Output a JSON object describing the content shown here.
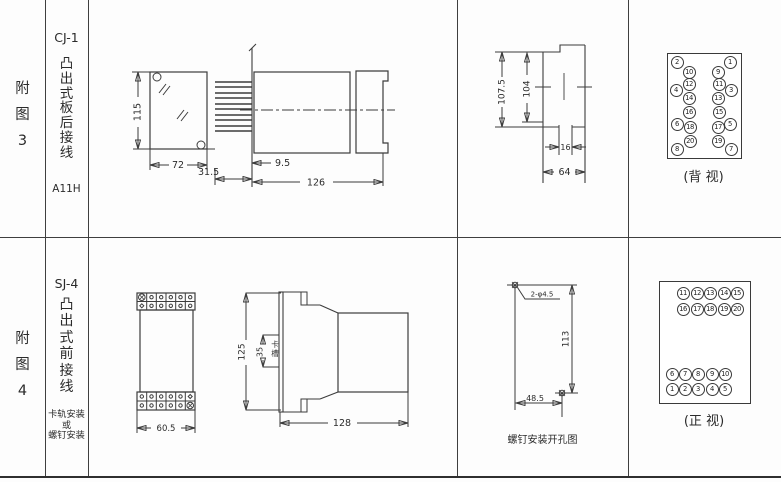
{
  "colors": {
    "line": "#3c3c3c",
    "text": "#2b2b2b"
  },
  "fig3": {
    "row_label": "附图3",
    "model": "CJ-1",
    "mount_type": "凸出式板后接线",
    "code": "A11H",
    "front": {
      "h": "115",
      "w": "72"
    },
    "side": {
      "pin_len": "31.5",
      "offset": "9.5",
      "len": "126"
    },
    "panel": {
      "outer_h": "107.5",
      "inner_h": "104",
      "slot_w": "16",
      "w": "64"
    },
    "terminals": {
      "caption": "(背 视)",
      "items": [
        {
          "n": "2",
          "x": 9,
          "y": 8
        },
        {
          "n": "10",
          "x": 21,
          "y": 18
        },
        {
          "n": "12",
          "x": 21,
          "y": 30
        },
        {
          "n": "4",
          "x": 8,
          "y": 36
        },
        {
          "n": "14",
          "x": 21,
          "y": 44
        },
        {
          "n": "16",
          "x": 21,
          "y": 58
        },
        {
          "n": "6",
          "x": 9,
          "y": 70
        },
        {
          "n": "18",
          "x": 22,
          "y": 73
        },
        {
          "n": "20",
          "x": 22,
          "y": 87
        },
        {
          "n": "8",
          "x": 9,
          "y": 95
        },
        {
          "n": "1",
          "x": 62,
          "y": 8
        },
        {
          "n": "9",
          "x": 50,
          "y": 18
        },
        {
          "n": "11",
          "x": 51,
          "y": 30
        },
        {
          "n": "3",
          "x": 63,
          "y": 36
        },
        {
          "n": "13",
          "x": 50,
          "y": 44
        },
        {
          "n": "15",
          "x": 51,
          "y": 58
        },
        {
          "n": "5",
          "x": 62,
          "y": 70
        },
        {
          "n": "17",
          "x": 50,
          "y": 73
        },
        {
          "n": "19",
          "x": 50,
          "y": 87
        },
        {
          "n": "7",
          "x": 63,
          "y": 95
        }
      ]
    }
  },
  "fig4": {
    "row_label": "附图4",
    "model": "SJ-4",
    "mount_type": "凸出式前接线",
    "mount_notes": [
      "卡轨安装",
      "或",
      "螺钉安装"
    ],
    "front": {
      "w": "60.5"
    },
    "side": {
      "h": "125",
      "slot_h": "35",
      "slot_label": "卡槽",
      "len": "128"
    },
    "drill": {
      "holes": "2-φ4.5",
      "v": "113",
      "h": "48.5",
      "caption": "螺钉安装开孔图"
    },
    "terminals": {
      "caption": "(正 视)",
      "items": [
        {
          "n": "11",
          "x": 23,
          "y": 11
        },
        {
          "n": "12",
          "x": 37,
          "y": 11
        },
        {
          "n": "13",
          "x": 50,
          "y": 11
        },
        {
          "n": "14",
          "x": 64,
          "y": 11
        },
        {
          "n": "15",
          "x": 77,
          "y": 11
        },
        {
          "n": "16",
          "x": 23,
          "y": 27
        },
        {
          "n": "17",
          "x": 37,
          "y": 27
        },
        {
          "n": "18",
          "x": 50,
          "y": 27
        },
        {
          "n": "19",
          "x": 64,
          "y": 27
        },
        {
          "n": "20",
          "x": 77,
          "y": 27
        },
        {
          "n": "6",
          "x": 12,
          "y": 92
        },
        {
          "n": "7",
          "x": 25,
          "y": 92
        },
        {
          "n": "8",
          "x": 38,
          "y": 92
        },
        {
          "n": "9",
          "x": 52,
          "y": 92
        },
        {
          "n": "10",
          "x": 65,
          "y": 92
        },
        {
          "n": "1",
          "x": 12,
          "y": 107
        },
        {
          "n": "2",
          "x": 25,
          "y": 107
        },
        {
          "n": "3",
          "x": 38,
          "y": 107
        },
        {
          "n": "4",
          "x": 52,
          "y": 107
        },
        {
          "n": "5",
          "x": 65,
          "y": 107
        }
      ]
    }
  }
}
